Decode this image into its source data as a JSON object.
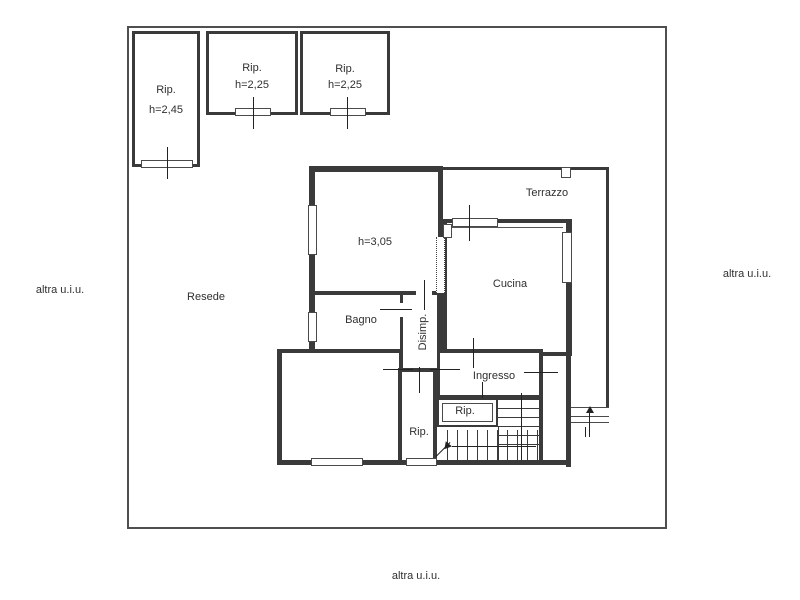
{
  "style": {
    "wall_color": "#3a3a3a",
    "background": "#ffffff",
    "text_color": "#2f2f2f"
  },
  "plan": {
    "outside_labels": {
      "left": "altra u.i.u.",
      "right": "altra u.i.u.",
      "bottom": "altra u.i.u."
    },
    "yard_label": "Resede",
    "rooms": {
      "storage1_name": "Rip.",
      "storage1_height": "h=2,45",
      "storage2_name": "Rip.",
      "storage2_height": "h=2,25",
      "storage3_name": "Rip.",
      "storage3_height": "h=2,25",
      "main_room_height": "h=3,05",
      "terrace": "Terrazzo",
      "kitchen": "Cucina",
      "bathroom": "Bagno",
      "hallway": "Disimp.",
      "entrance": "Ingresso",
      "closet": "Rip.",
      "storage_nook": "Rip."
    }
  }
}
